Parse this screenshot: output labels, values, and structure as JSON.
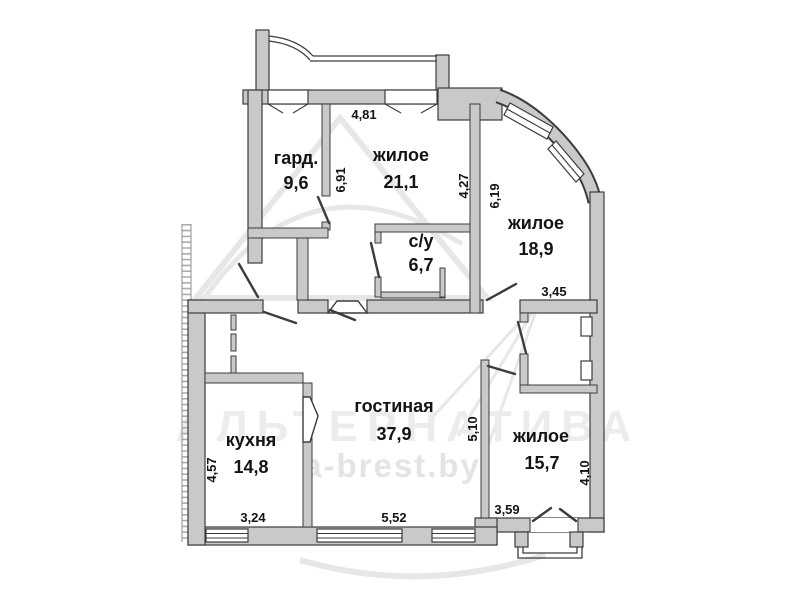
{
  "plan_title": "apartment-floor-plan",
  "colors": {
    "wall_fill": "#c9c9c9",
    "line": "#3c3c3c",
    "watermark": "#ececec"
  },
  "watermark": {
    "brand": "АЛЬТЕРНАТИВА",
    "site": "a-brest.by"
  },
  "rooms": [
    {
      "id": "gard",
      "name": "гард.",
      "area": "9,6"
    },
    {
      "id": "zhiloe-21",
      "name": "жилое",
      "area": "21,1"
    },
    {
      "id": "zhiloe-18",
      "name": "жилое",
      "area": "18,9"
    },
    {
      "id": "su",
      "name": "с/у",
      "area": "6,7"
    },
    {
      "id": "gostinaya",
      "name": "гостиная",
      "area": "37,9"
    },
    {
      "id": "kuhnya",
      "name": "кухня",
      "area": "14,8"
    },
    {
      "id": "zhiloe-15",
      "name": "жилое",
      "area": "15,7"
    }
  ],
  "dimensions": [
    {
      "id": "dim-4-81",
      "value": "4,81",
      "orientation": "horizontal"
    },
    {
      "id": "dim-6-91",
      "value": "6,91",
      "orientation": "vertical"
    },
    {
      "id": "dim-4-27",
      "value": "4,27",
      "orientation": "vertical"
    },
    {
      "id": "dim-6-19",
      "value": "6,19",
      "orientation": "vertical"
    },
    {
      "id": "dim-3-45",
      "value": "3,45",
      "orientation": "horizontal"
    },
    {
      "id": "dim-5-10",
      "value": "5,10",
      "orientation": "vertical"
    },
    {
      "id": "dim-4-10",
      "value": "4,10",
      "orientation": "vertical"
    },
    {
      "id": "dim-3-59",
      "value": "3,59",
      "orientation": "horizontal"
    },
    {
      "id": "dim-5-52",
      "value": "5,52",
      "orientation": "horizontal"
    },
    {
      "id": "dim-3-24",
      "value": "3,24",
      "orientation": "horizontal"
    },
    {
      "id": "dim-4-57",
      "value": "4,57",
      "orientation": "vertical"
    }
  ]
}
